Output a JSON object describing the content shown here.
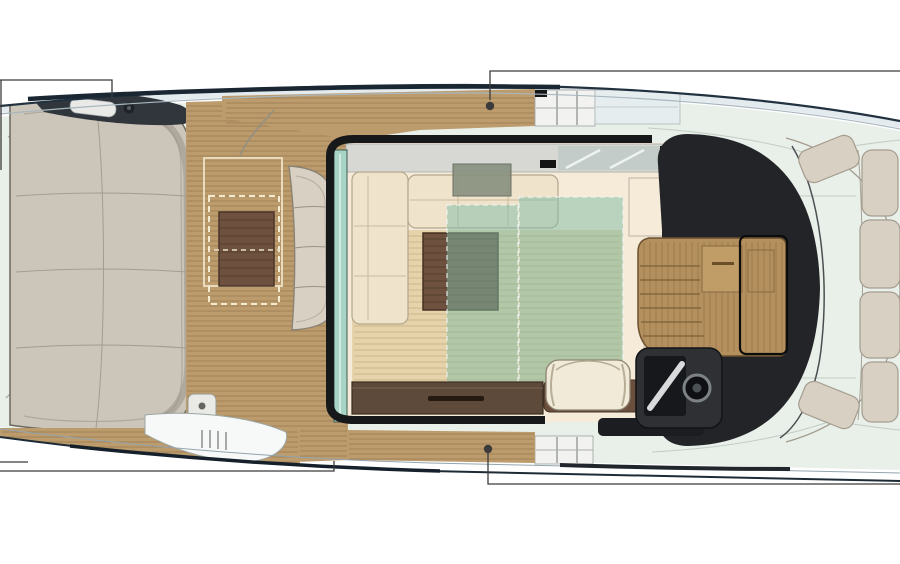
{
  "meta": {
    "title": "Motor yacht main deck floor plan, top view, bow to the right",
    "text_visible": "none"
  },
  "labels": {
    "plan": "Motor yacht main deck floor plan",
    "deck": "Deck base",
    "aft_sunpad": "Aft sunpad lounge",
    "cockpit": "Aft cockpit teak deck",
    "dinette_table": "Cockpit dining table",
    "table_extension": "Dashed table-extension outline",
    "cockpit_bench": "Curved cockpit bench",
    "shower_box": "Cockpit locker with cap",
    "top_gate": "Port side-deck boarding gate",
    "bottom_gate": "Starboard side-deck boarding gate",
    "side_deck": "Side deck teak walkway",
    "hull_glazing": "Hull side boarding step with ladder",
    "salon": "Main salon",
    "sunroof": "Salon sunroof rail",
    "glass_door": "Aft sliding glass door",
    "sofa": "L-shaped salon sofa",
    "tv_unit": "Wall unit on sofa side",
    "coffee_table": "Coffee table",
    "carpet_a": "Translucent carpet overlay A",
    "carpet_b": "Translucent carpet overlay B",
    "sideboard": "Starboard sideboard cabinet",
    "galley": "Galley counter and companionway stairs",
    "walkthrough": "Teak walkthrough door to foredeck",
    "windshield": "Windshield / dark superstructure mass",
    "helm_seat": "Helm seat",
    "helm_console": "Helm console with screen",
    "steering_wheel": "Steering wheel",
    "foredeck": "Foredeck",
    "bow_seating": "Curved bow seating cushions",
    "hull": "Hull outline",
    "callouts": "Unlabeled leader-line callouts"
  },
  "callouts": [
    {
      "position": "top-left",
      "style": "bracket",
      "points_to": "transom hardware / aft sunpad"
    },
    {
      "position": "top-center",
      "style": "dot-leader",
      "points_to": "port side deck by boarding gate"
    },
    {
      "position": "bottom-left",
      "style": "bracket",
      "points_to": "hull side boarding step"
    },
    {
      "position": "bottom-center",
      "style": "dot-leader",
      "points_to": "starboard side deck by boarding gate"
    }
  ],
  "colors": {
    "white": "#ffffff",
    "hull_fill": "#fcfdfd",
    "hull_line": "#22313f",
    "deck": "#e9efe9",
    "teak": "#bc9b6c",
    "sunpad": "#cbc5ba",
    "cushion": "#d8d1c3",
    "salon_floor": "#f6ebd8",
    "salon_wood": "#e6d2ab",
    "sofa": "#f0e3cb",
    "table": "#6f513f",
    "teal": "#7ebca6",
    "sideboard": "#5e4a3a",
    "dark": "#232428",
    "galley": "#b3905d",
    "console": "#2e3034",
    "seat": "#f2ead9",
    "seat_base": "#6b4f3d",
    "glass": "#a8d4c6",
    "band": "#d7d8d4",
    "gate_panel": "#f2f3f1",
    "callout": "#3b3b3b"
  }
}
